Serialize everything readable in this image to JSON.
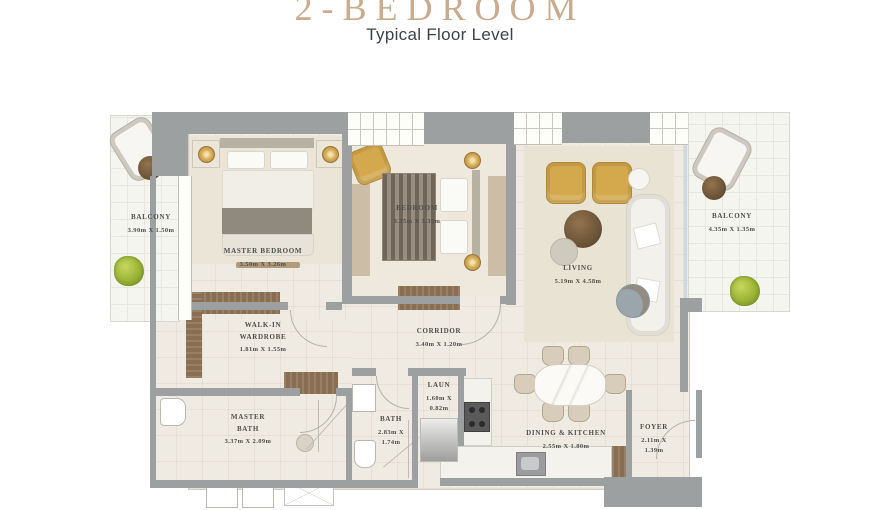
{
  "header": {
    "title": "2-BEDROOM",
    "subtitle": "Typical Floor Level"
  },
  "rooms": {
    "balcony_left": {
      "name": "BALCONY",
      "dims": "3.90m X 1.50m"
    },
    "master_bedroom": {
      "name": "MASTER BEDROOM",
      "dims": "3.50m X 3.26m"
    },
    "bedroom": {
      "name": "BEDROOM",
      "dims": "3.35m X 3.35m"
    },
    "living": {
      "name": "LIVING",
      "dims": "5.19m X 4.58m"
    },
    "balcony_right": {
      "name": "BALCONY",
      "dims": "4.35m X 1.35m"
    },
    "walkin_wardrobe": {
      "name": "WALK-IN WARDROBE",
      "dims": "1.81m X 1.55m"
    },
    "corridor": {
      "name": "CORRIDOR",
      "dims": "3.40m X 1.20m"
    },
    "laundry": {
      "name": "LAUN",
      "dims": "1.60m X 0.82m"
    },
    "bath": {
      "name": "BATH",
      "dims": "2.83m X 1.74m"
    },
    "master_bath": {
      "name": "MASTER BATH",
      "dims": "3.37m X 2.09m"
    },
    "dining_kitchen": {
      "name": "DINING & KITCHEN",
      "dims": "2.55m X 1.80m"
    },
    "foyer": {
      "name": "FOYER",
      "dims": "2.11m X 1.39m"
    }
  },
  "colors": {
    "title_accent": "#c9ab8d",
    "subtitle_text": "#3d4248",
    "wall_gray": "#9da0a1",
    "floor_cream": "#f0ebe2",
    "balcony_floor": "#f5f5ef",
    "wood_brown": "#8a6e52",
    "armchair_yellow": "#d4a84d",
    "plant_green": "#9ab236",
    "label_text": "#4e4e4e"
  }
}
